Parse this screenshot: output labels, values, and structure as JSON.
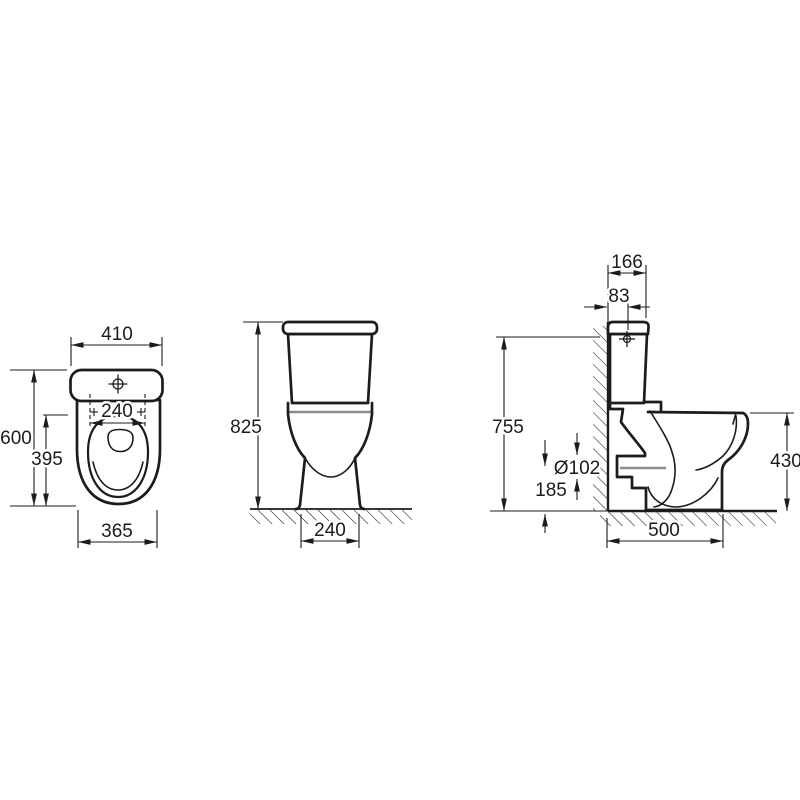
{
  "colors": {
    "line": "#1c1c1c",
    "secondary": "#8c8c8c",
    "background": "#ffffff"
  },
  "views": {
    "top_view": {
      "dims": {
        "tank_width": "410",
        "total_depth": "600",
        "seat_inner_width": "240",
        "bowl_depth": "395",
        "bowl_width": "365"
      }
    },
    "front_view": {
      "dims": {
        "total_height": "825",
        "base_width": "240"
      }
    },
    "side_view": {
      "dims": {
        "tank_depth": "166",
        "inlet_offset_from_wall": "83",
        "cistern_height": "755",
        "outlet_diameter": "Ø102",
        "outlet_axis_height": "185",
        "rim_height": "430",
        "total_depth_from_wall": "500"
      }
    }
  }
}
